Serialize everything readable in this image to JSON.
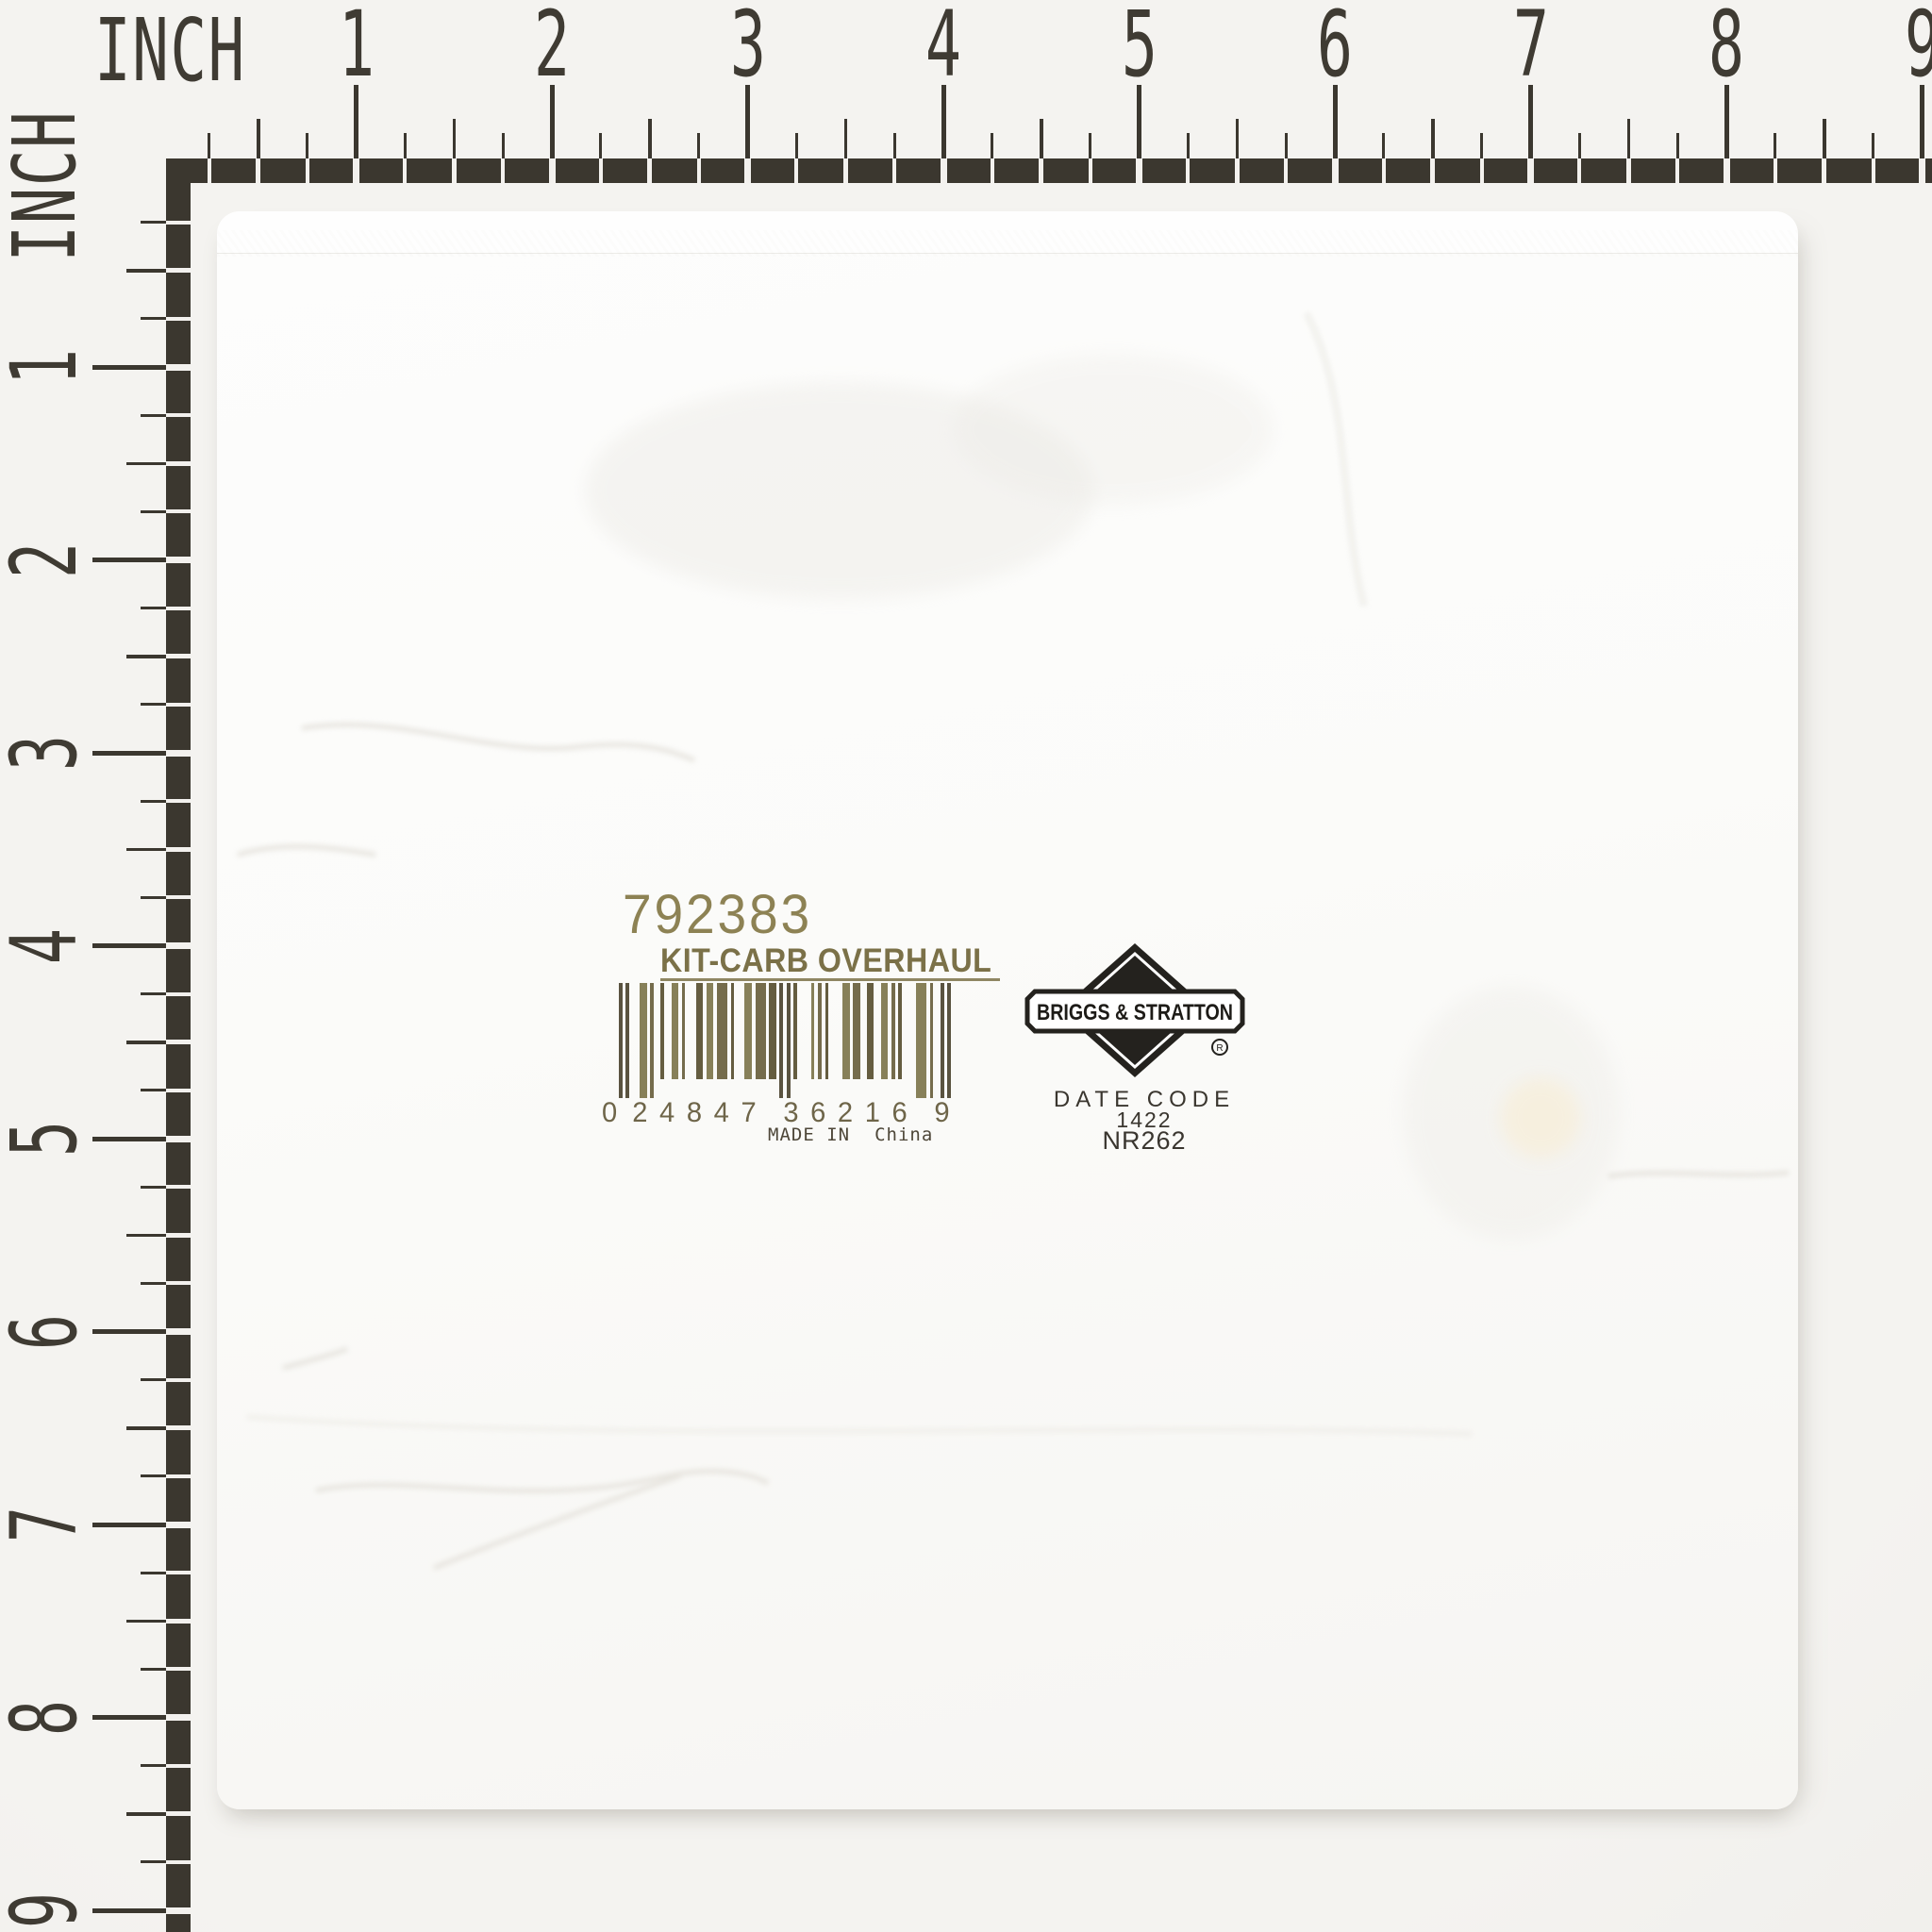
{
  "ruler": {
    "unit": "INCH",
    "top_numbers": [
      "1",
      "2",
      "3",
      "4",
      "5",
      "6",
      "7",
      "8",
      "9"
    ],
    "left_numbers": [
      "1",
      "2",
      "3",
      "4",
      "5",
      "6",
      "7",
      "8",
      "9"
    ],
    "ink_color": "#3b372f"
  },
  "label": {
    "part_number": "792383",
    "description": "KIT-CARB OVERHAUL",
    "upc_digits": "024847362169",
    "upc_lead_digit": "0",
    "upc_group1": "24847",
    "upc_group2": "36216",
    "upc_check_digit": "9",
    "made_in_label": "MADE IN",
    "made_in_value": "China",
    "ink_color": "#857a4f"
  },
  "brand": {
    "name": "BRIGGS & STRATTON",
    "registered": "®",
    "date_code_label": "DATE CODE",
    "date_code": "1422",
    "batch_code": "NR262",
    "ink_color": "#26231e"
  }
}
